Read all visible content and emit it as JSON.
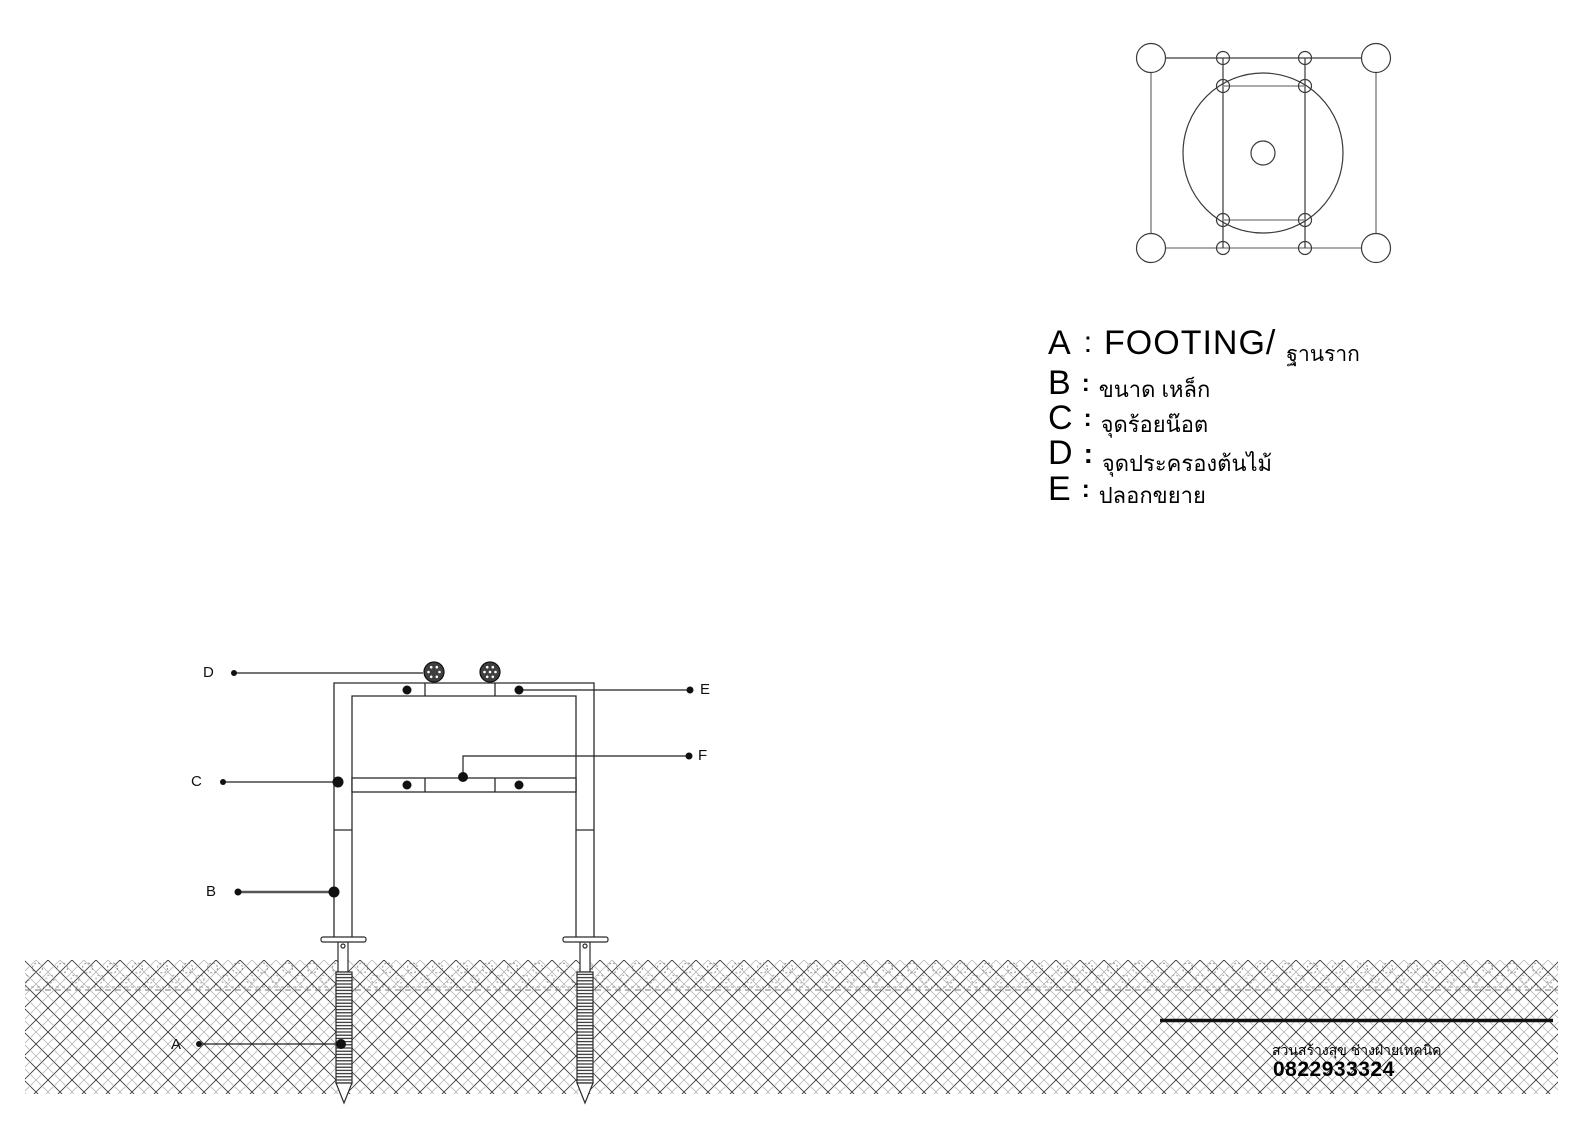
{
  "legend": {
    "items": [
      {
        "letter": "A",
        "separator": ":",
        "label_en": "FOOTING/",
        "label_th": "ฐานราก"
      },
      {
        "letter": "B",
        "separator": ":",
        "label_th": "ขนาด เหล็ก"
      },
      {
        "letter": "C",
        "separator": ":",
        "label_th": "จุดร้อยน๊อต"
      },
      {
        "letter": "D",
        "separator": ":",
        "label_th": "จุดประครองต้นไม้"
      },
      {
        "letter": "E",
        "separator": ":",
        "label_th": "ปลอกขยาย"
      }
    ]
  },
  "elevation_callouts": {
    "A": "A",
    "B": "B",
    "C": "C",
    "D": "D",
    "E": "E",
    "F": "F"
  },
  "footer": {
    "org": "สวนสร้างสุข ช่างฝ่ายเทคนิค",
    "phone": "0822933324"
  },
  "colors": {
    "background": "#ffffff",
    "line_dark": "#2b2b2b",
    "line_gray": "#8f8f8f",
    "hatch_dark": "#3a3a3a",
    "hatch_light": "#b5b5b5",
    "bolt_fill": "#3f3f3f",
    "text": "#000000"
  }
}
